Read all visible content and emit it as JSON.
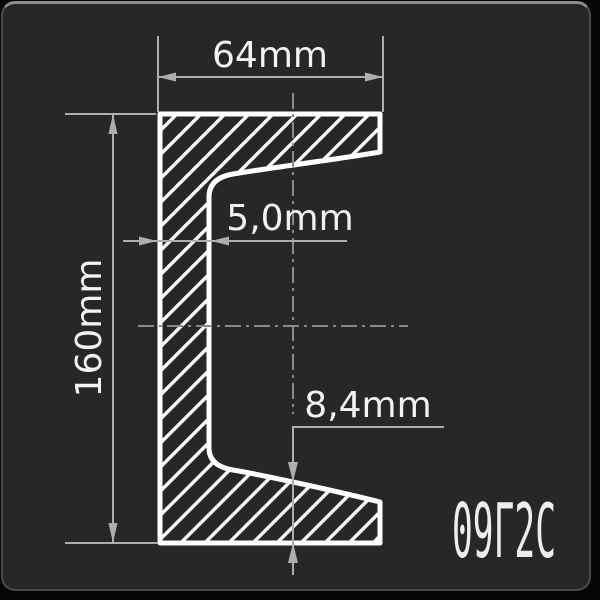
{
  "drawing": {
    "dimensions": {
      "width_label": "64mm",
      "height_label": "160mm",
      "web_thickness_label": "5,0mm",
      "flange_thickness_label": "8,4mm"
    },
    "steel_grade_label": "09Г2С",
    "colors": {
      "panel_background": "#272727",
      "outside_background": "#050505",
      "panel_border": "#4a4a4a",
      "panel_border_top": "#8e8e8e",
      "profile_line": "#ffffff",
      "dimension_line": "#aeaeae",
      "dimension_text": "#f3f3f3",
      "centerline": "#8a8a8a",
      "steel_grade_text": "#ededed"
    }
  }
}
